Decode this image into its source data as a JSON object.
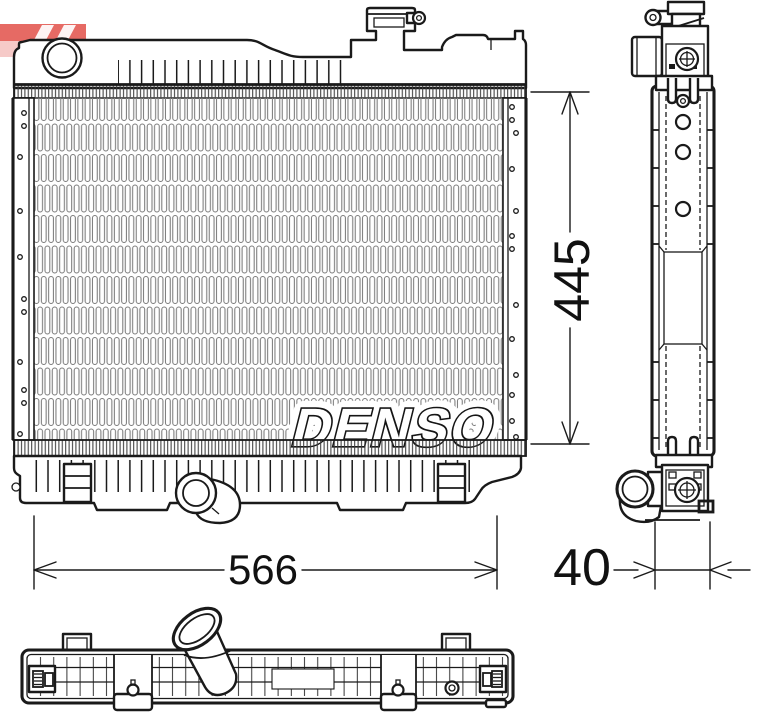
{
  "watermark": {
    "text": "DENSO"
  },
  "dimensions": {
    "height": "445",
    "width": "566",
    "depth": "40"
  },
  "logo": {
    "color": "#df4038",
    "light": "#f2b4b0"
  },
  "colors": {
    "line": "#1a1a1a",
    "background": "#ffffff",
    "hatch": "#777777"
  }
}
